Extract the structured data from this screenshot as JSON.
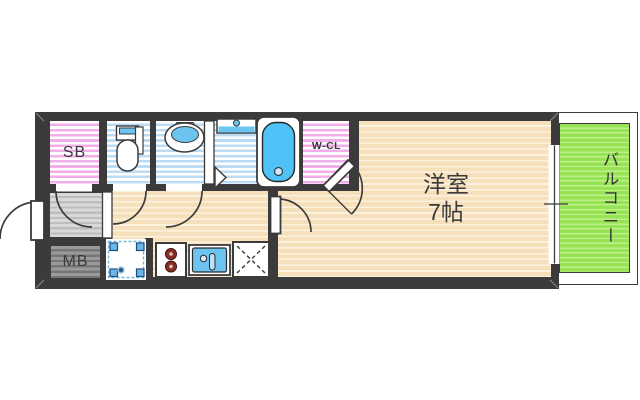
{
  "plan_type": "apartment-floor-plan",
  "rooms": {
    "shoe_box": {
      "label": "SB"
    },
    "walk_in_closet": {
      "label": "W-CL"
    },
    "western_room": {
      "label_name": "洋室",
      "label_size": "7帖"
    },
    "balcony": {
      "label": "バルコニー"
    },
    "meter_box": {
      "label": "MB"
    }
  },
  "fixtures": [
    "toilet",
    "washbasin",
    "bathtub",
    "bath-counter",
    "entrance-door",
    "interior-doors",
    "washing-machine-pan",
    "gas-stove",
    "kitchen-sink",
    "refrigerator-space",
    "sliding-window"
  ],
  "colors": {
    "wall": "#3b3b3b",
    "room_floor_beige": "#f6e0bc",
    "wet_area_blue": "#bcdcf6",
    "closet_pink": "#f2aee8",
    "balcony_green": "#96e353",
    "entrance_gray": "#d9d9d9",
    "water_fixture_blue": "#6cc4f0"
  }
}
